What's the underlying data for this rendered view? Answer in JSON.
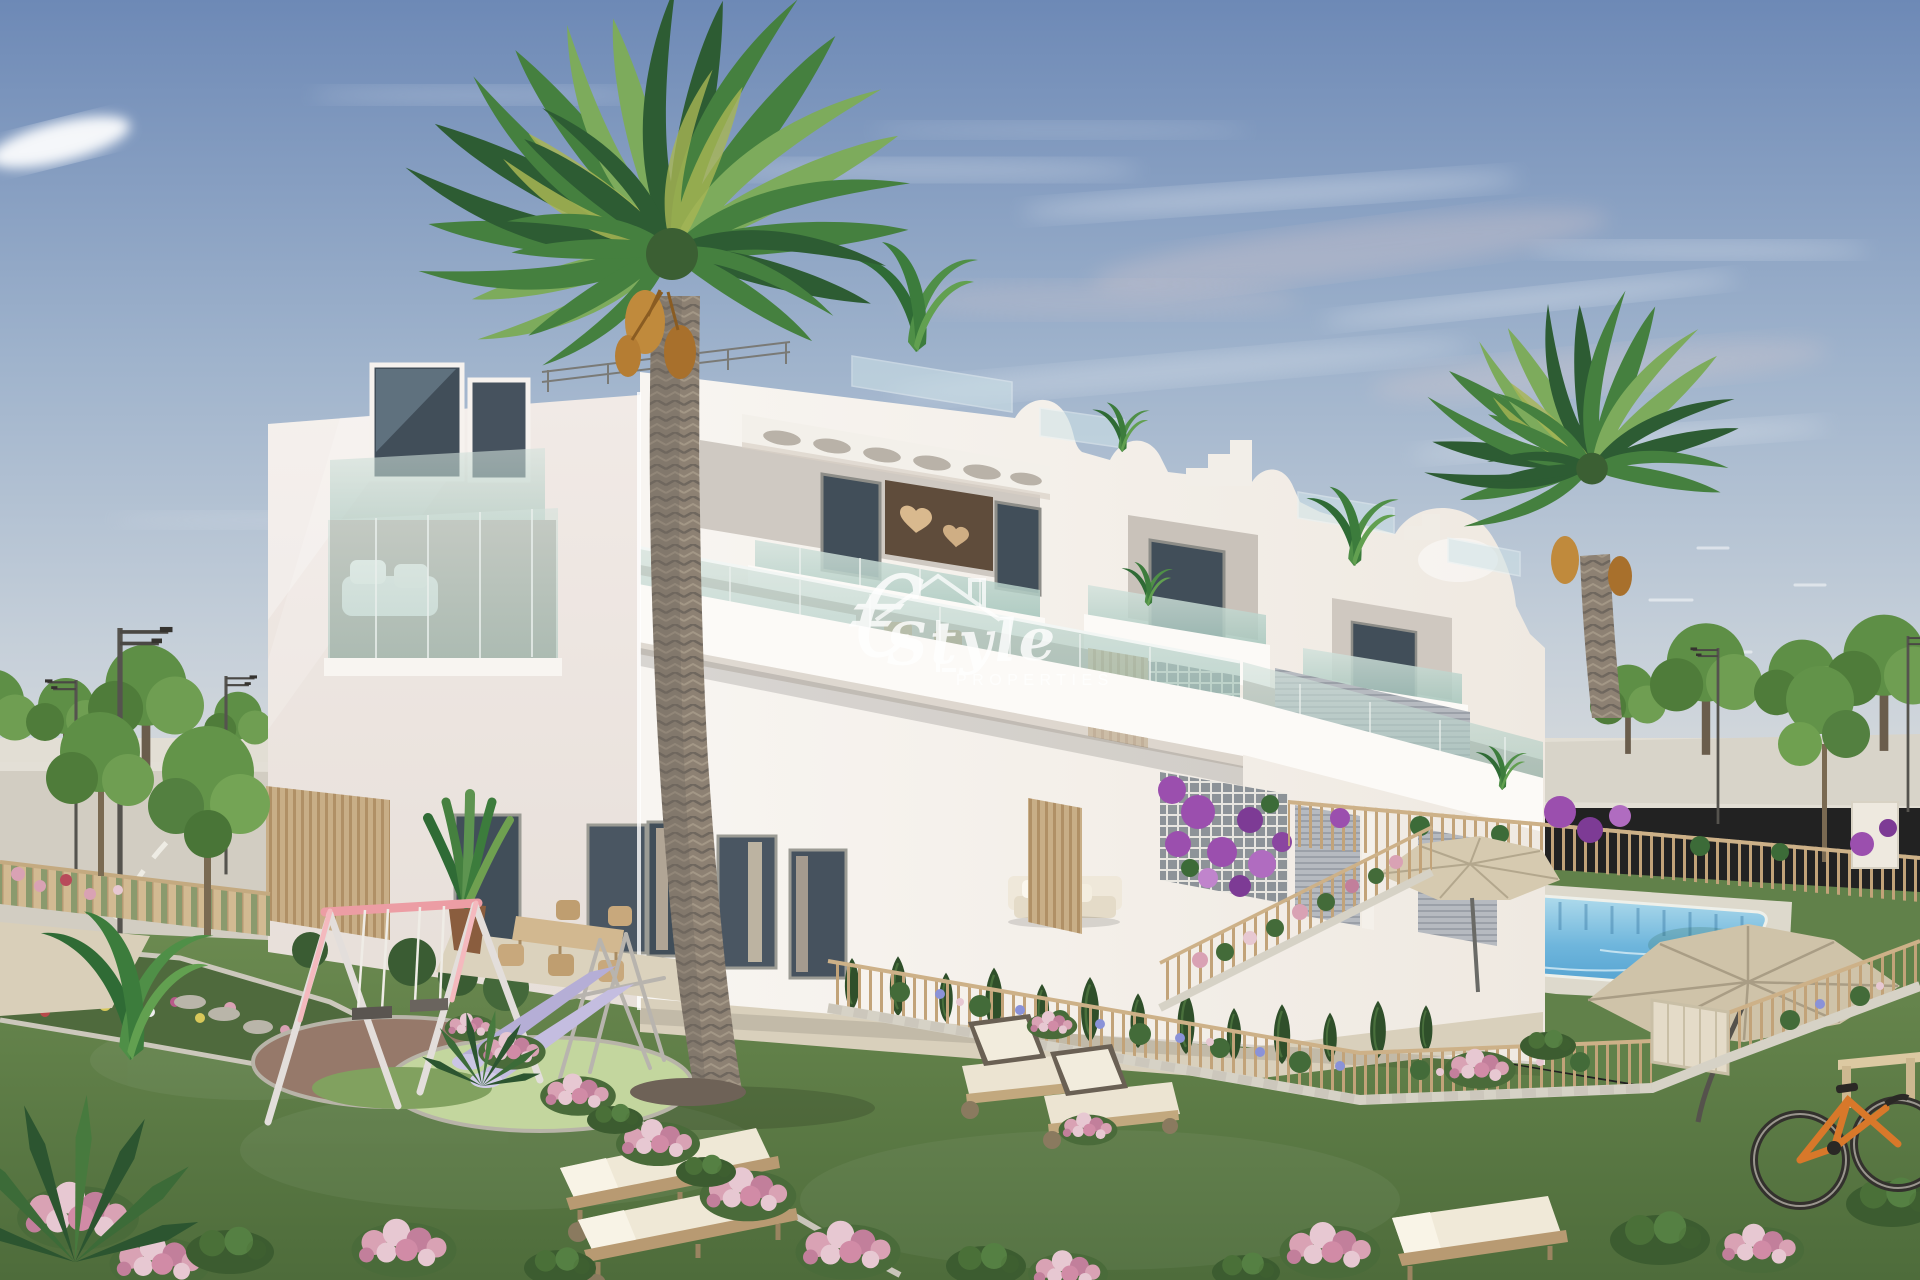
{
  "watermark": {
    "prefix": "€",
    "name": "Style",
    "subtitle": "PROPERTIES",
    "color": "#ffffff"
  },
  "colors": {
    "watermark": "#ffffff",
    "sky-top": "#6d89b6",
    "sky-mid": "#9fb3cc",
    "sky-horizon": "#d8dbdd",
    "cloud": "#ffffff",
    "cloud-pink": "#e4cfce",
    "building-front": "#f8f5f1",
    "building-left": "#f1eae6",
    "building-shade": "#e7e0d8",
    "parapet": "#fcfaf7",
    "glass-teal": "#a2c4ba",
    "window-dark": "#414e59",
    "wood-slat": "#c8ae87",
    "shutter-gray": "#b6bac0",
    "bronze-wall": "#5f4c3b",
    "grass-far": "#6b8a50",
    "grass-near": "#4e6c3b",
    "pool-light": "#bfe4f0",
    "pool-deep": "#4e9ecf",
    "fence-tan": "#c2a379",
    "stone": "#d6d2c6",
    "pavement": "#d2cdc2",
    "flower-pink": "#d9a2b4",
    "bougainvillea": "#9b4fae",
    "swing-pink": "#ec9da4",
    "slide-lavender": "#b5aed6",
    "parasol-beige": "#d6cab0",
    "bike-orange": "#d8782a",
    "palm-dark": "#2d5c33",
    "palm-mid": "#45803f",
    "palm-light": "#7dab5c",
    "palm-yellow": "#a8b554",
    "trunk-bark": "#8d8173",
    "tree-green": "#5e8f46",
    "lounger-cream": "#ece4d2"
  }
}
